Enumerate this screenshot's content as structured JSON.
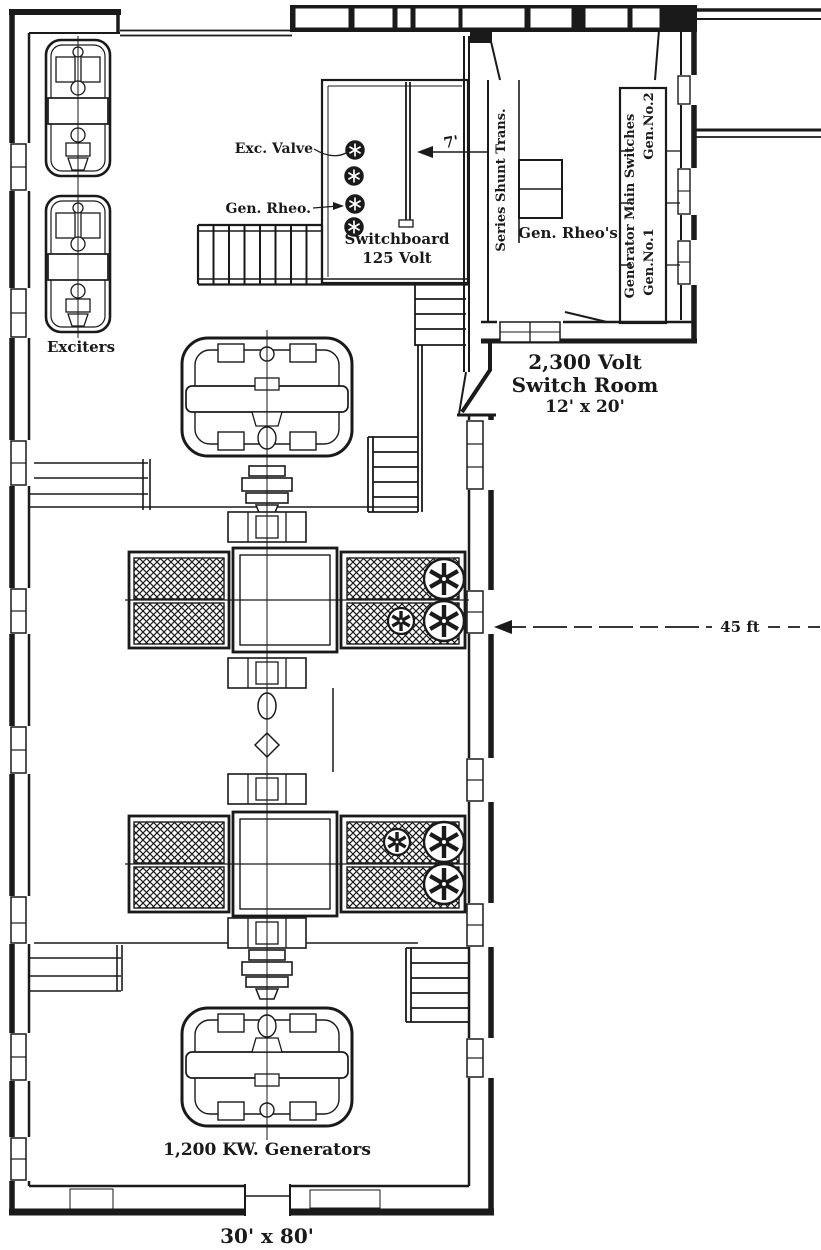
{
  "meta": {
    "background_color": "#ffffff",
    "ink_color": "#1a1a1a",
    "drawing_type": "power-station floor plan engraving"
  },
  "labels": {
    "exciters": "Exciters",
    "exc_valve": "Exc. Valve",
    "gen_rheo": "Gen. Rheo.",
    "switchboard_l1": "Switchboard",
    "switchboard_l2": "125 Volt",
    "dim_seven_ft": "7'",
    "series_shunt_trans": "Series Shunt Trans.",
    "gen_rheos": "Gen. Rheo's",
    "generator_main_switches": "Generator Main Switches",
    "gen_no1": "Gen.No.1",
    "gen_no2": "Gen.No.2",
    "switch_room_l1": "2,300 Volt",
    "switch_room_l2": "Switch Room",
    "switch_room_l3": "12' x 20'",
    "dim_45_ft": "45 ft",
    "generators": "1,200 KW. Generators",
    "room_size": "30' x 80'"
  }
}
